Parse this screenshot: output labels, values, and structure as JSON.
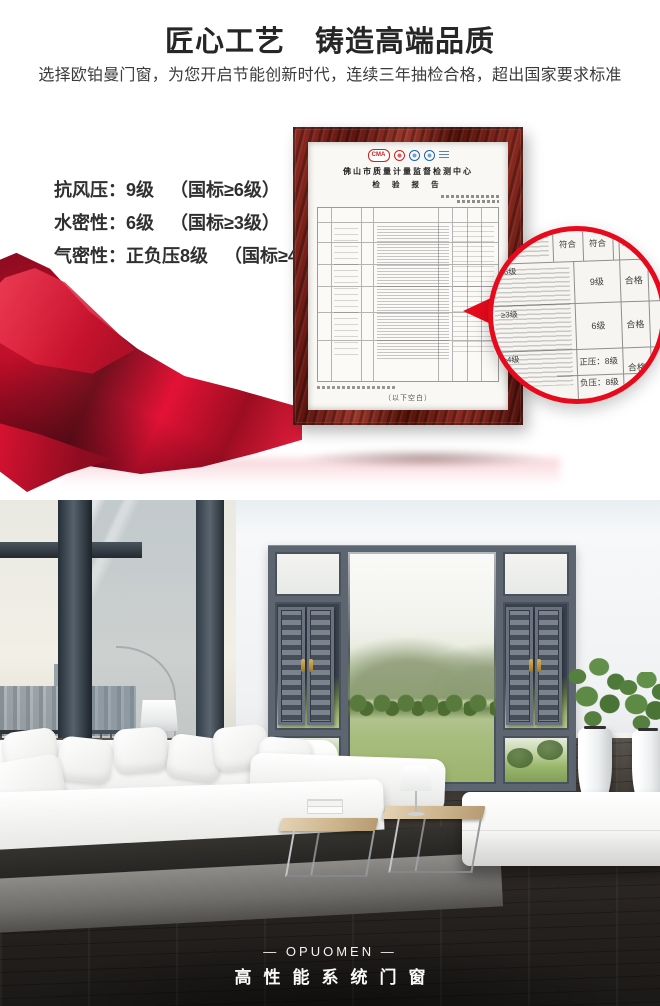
{
  "colors": {
    "accent_red": "#e60a1c",
    "title_text": "#262626",
    "frame_wood": "#7d221b",
    "window_gray": "#5d6571",
    "floor_dark": "#1b1917"
  },
  "header": {
    "title": "匠心工艺　铸造高端品质",
    "subtitle": "选择欧铂曼门窗，为您开启节能创新时代，连续三年抽检合格，超出国家要求标准"
  },
  "specs": {
    "items": [
      {
        "label": "抗风压：",
        "value": "9级",
        "standard": "（国标≥6级）"
      },
      {
        "label": "水密性：",
        "value": "6级",
        "standard": "（国标≥3级）"
      },
      {
        "label": "气密性：",
        "value": "正负压8级",
        "standard": "（国标≥4级）"
      }
    ]
  },
  "certificate": {
    "authority": "佛山市质量计量监督检测中心",
    "report_title": "检 验 报 告",
    "cma_label": "CMA",
    "blank_note": "（以下空白）"
  },
  "lens": {
    "pass_cells": [
      "符合",
      "符合",
      "符合"
    ],
    "rows": [
      {
        "standard": "≥6级",
        "result": "9级",
        "verdict": "合格"
      },
      {
        "standard": "≥3级",
        "result": "6级",
        "verdict": "合格"
      },
      {
        "standard": "≥4级",
        "result_positive": "正压：8级",
        "result_negative": "负压：8级",
        "verdict": "合格"
      }
    ]
  },
  "footer": {
    "brand": "— OPUOMEN —",
    "tagline": "高性能系统门窗"
  }
}
